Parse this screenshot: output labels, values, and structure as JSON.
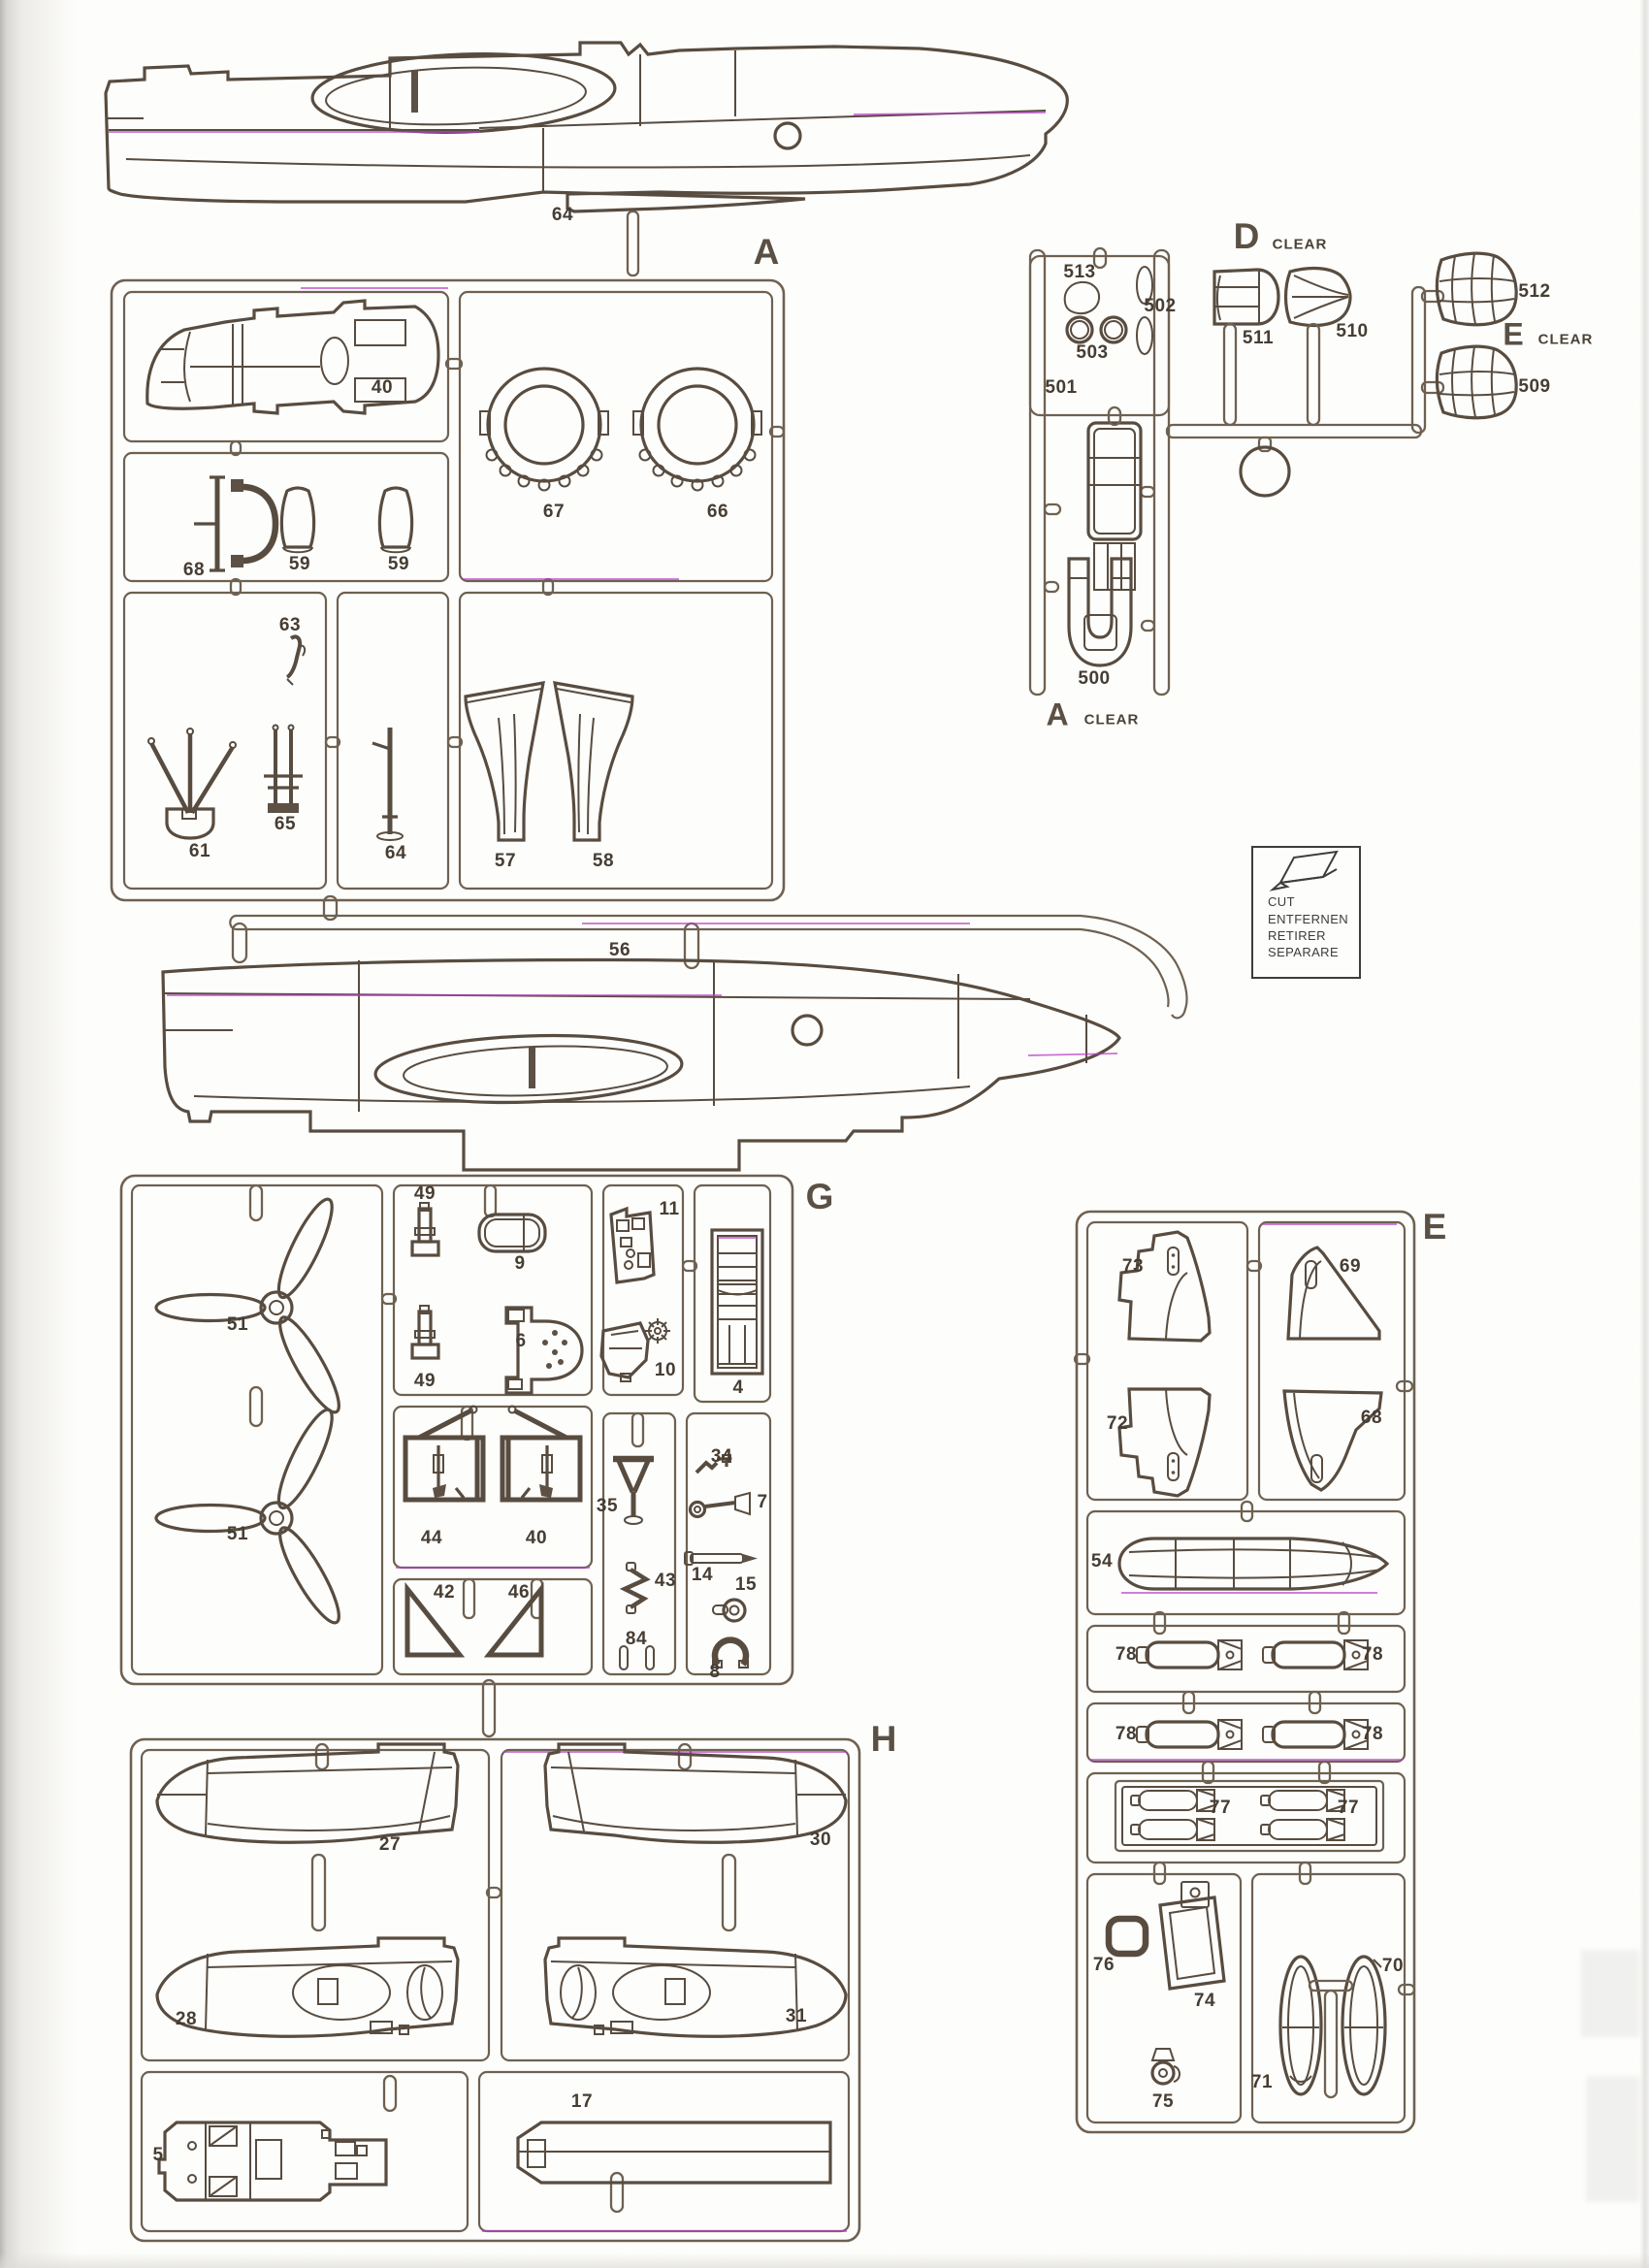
{
  "colors": {
    "line": "#584c40",
    "frame": "#6e6152",
    "label": "#463d33",
    "scan_artifact_magenta": "#b53fc4",
    "paper": "#fdfdfb"
  },
  "top_fuselage": {
    "part64": "64"
  },
  "mid_fuselage": {
    "part56": "56"
  },
  "sprue_a": {
    "letter": "A",
    "p40": "40",
    "p67": "67",
    "p66": "66",
    "p68": "68",
    "p59_1": "59",
    "p59_2": "59",
    "p63": "63",
    "p61": "61",
    "p65": "65",
    "p64": "64",
    "p57": "57",
    "p58": "58"
  },
  "clear_a": {
    "letter": "A",
    "clear": "CLEAR",
    "p513": "513",
    "p502": "502",
    "p503": "503",
    "p501": "501",
    "p500": "500"
  },
  "clear_d": {
    "letter": "D",
    "clear": "CLEAR",
    "p511": "511",
    "p510": "510"
  },
  "clear_e": {
    "letter": "E",
    "clear": "CLEAR",
    "p512": "512",
    "p509": "509"
  },
  "cut_box": {
    "l1": "CUT",
    "l2": "ENTFERNEN",
    "l3": "RETIRER",
    "l4": "SEPARARE"
  },
  "sprue_g": {
    "letter": "G",
    "p51_1": "51",
    "p51_2": "51",
    "p49_1": "49",
    "p49_2": "49",
    "p9": "9",
    "p6": "6",
    "p11": "11",
    "p10": "10",
    "p4": "4",
    "p44": "44",
    "p40": "40",
    "p42": "42",
    "p46": "46",
    "p35": "35",
    "p43": "43",
    "p84": "84",
    "p34": "34",
    "p7": "7",
    "p14": "14",
    "p15": "15",
    "p8": "8"
  },
  "sprue_h": {
    "letter": "H",
    "p27": "27",
    "p30": "30",
    "p28": "28",
    "p31": "31",
    "p5": "5",
    "p17": "17"
  },
  "sprue_e": {
    "letter": "E",
    "p73": "73",
    "p69": "69",
    "p72": "72",
    "p68": "68",
    "p54": "54",
    "p78_1": "78",
    "p78_2": "78",
    "p78_3": "78",
    "p78_4": "78",
    "p77_1": "77",
    "p77_2": "77",
    "p76": "76",
    "p74": "74",
    "p75": "75",
    "p71": "71",
    "p70": "70"
  }
}
